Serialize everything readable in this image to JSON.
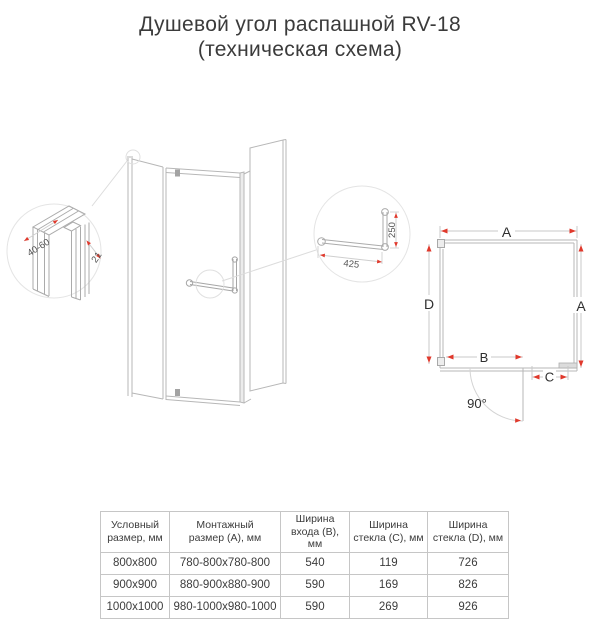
{
  "title": {
    "line1": "Душевой угол распашной RV-18",
    "line2": "(техническая схема)"
  },
  "colors": {
    "accent_red": "#e0392c",
    "drawing_line": "#b7b7b7",
    "detail_line": "#ababab"
  },
  "profile_detail": {
    "width_range": "40-60",
    "depth": "21"
  },
  "handle_detail": {
    "length": "425",
    "height": "250"
  },
  "plan": {
    "dim_top": "A",
    "dim_left": "D",
    "dim_right": "A",
    "dim_opening": "B",
    "dim_side_panel": "C",
    "door_angle": "90°"
  },
  "table": {
    "headers": [
      {
        "line1": "Условный",
        "line2": "размер, мм"
      },
      {
        "line1": "Монтажный",
        "line2": "размер (А), мм"
      },
      {
        "line1": "Ширина",
        "line2": "входа (B), мм"
      },
      {
        "line1": "Ширина",
        "line2": "стекла (C), мм"
      },
      {
        "line1": "Ширина",
        "line2": "стекла (D), мм"
      }
    ],
    "rows": [
      [
        "800x800",
        "780-800x780-800",
        "540",
        "119",
        "726"
      ],
      [
        "900x900",
        "880-900x880-900",
        "590",
        "169",
        "826"
      ],
      [
        "1000x1000",
        "980-1000x980-1000",
        "590",
        "269",
        "926"
      ]
    ]
  }
}
